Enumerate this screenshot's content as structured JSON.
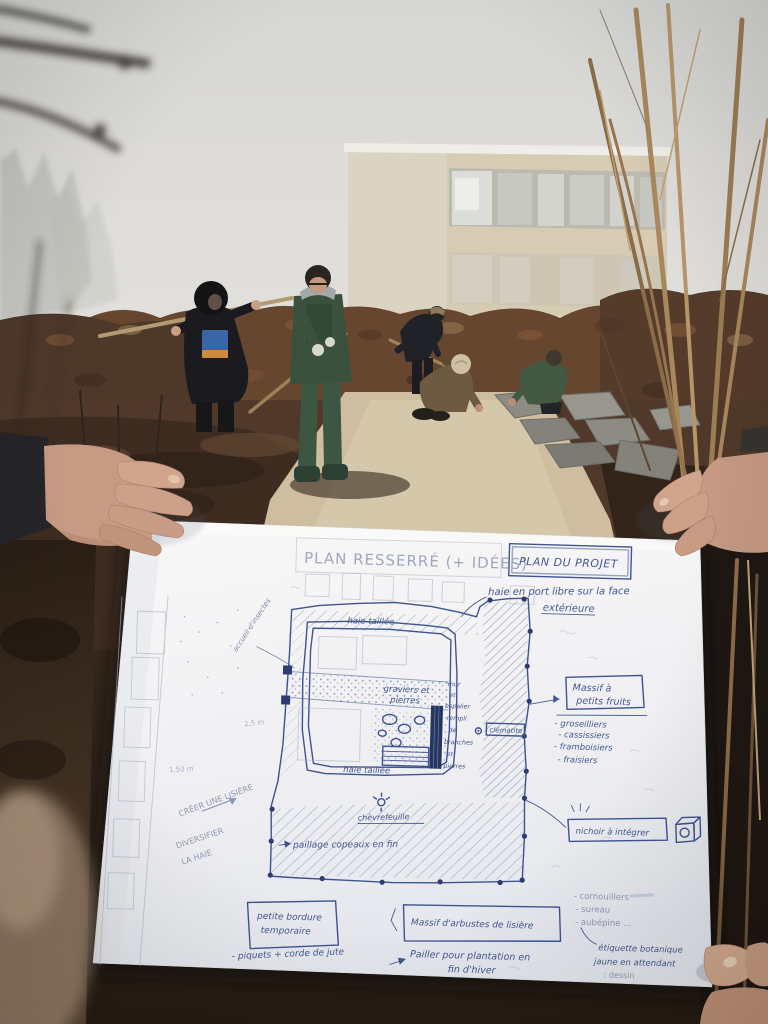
{
  "plan": {
    "title": "PLAN RESSERRÉ (+ IDÉES)",
    "project_box": "PLAN DU PROJET",
    "note_haie_libre_1": "haie en port libre sur la face",
    "note_haie_libre_2": "extérieure",
    "haie_taillee_top": "haie taillée",
    "haie_taillee_bottom": "haie taillée",
    "graviers_1": "graviers et",
    "graviers_2": "pierres",
    "clematite": "clématite",
    "accueil_insectes": "accueil d'insectes",
    "mur_words": [
      "mur",
      "et",
      "espalier",
      "rempli",
      "de",
      "branches",
      "et",
      "pierres"
    ],
    "massif_fruits_title_1": "Massif à",
    "massif_fruits_title_2": "petits fruits",
    "massif_fruits_items": [
      "- groseilliers",
      "- cassissiers",
      "- framboisiers",
      "- fraisiers"
    ],
    "nichoir": "nichoir à intégrer",
    "creer_lisiere": "CRÉER UNE LISIÈRE",
    "diversifier_1": "DIVERSIFIER",
    "diversifier_2": "LA HAIE",
    "paillage": "paillage copeaux en fin",
    "chevrefeuille": "chèvrefeuille",
    "bordure_1": "petite bordure",
    "bordure_2": "temporaire",
    "piquets": "- piquets + corde de jute",
    "massif_arbustes": "Massif d'arbustes de lisière",
    "pailler_1": "Pailler pour plantation en",
    "pailler_2": "fin d'hiver",
    "especes": [
      "- cornouillers",
      "- sureau",
      "- aubépine ..."
    ],
    "etiquette_1": "étiquette botanique",
    "etiquette_2": "jaune en attendant",
    "etiquette_3": ": dessin",
    "mesure_1": "2,5 m",
    "mesure_2": "1,50 m",
    "icons": {
      "nichoir_icon": "birdhouse-cube",
      "chevrefeuille_icon": "flower-mark",
      "clematite_icon": "flower-mark"
    },
    "colors": {
      "ink": "#3e5390",
      "pencil": "#9fa6bd",
      "paper": "#f6f6f7"
    }
  }
}
